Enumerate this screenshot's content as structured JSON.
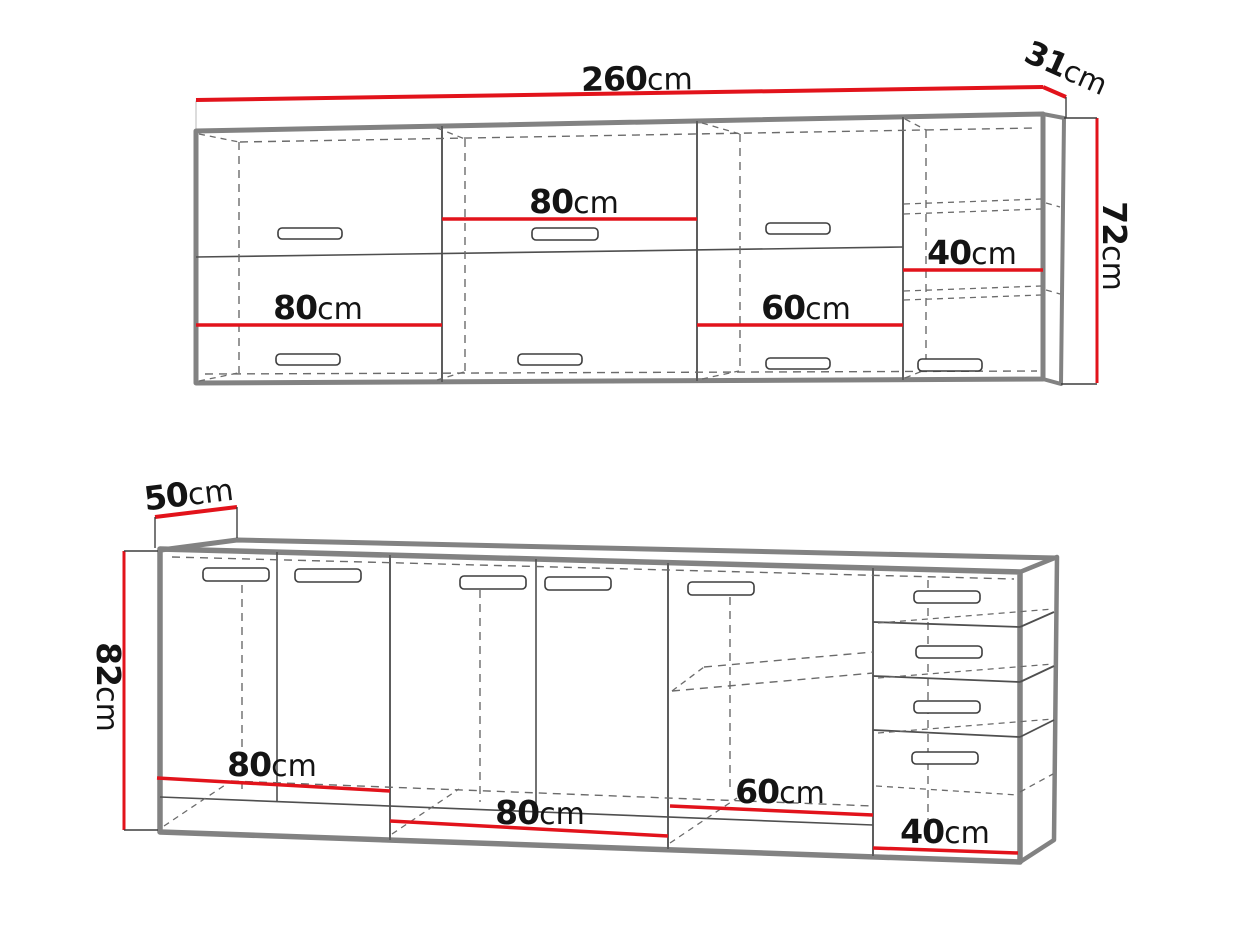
{
  "diagram": {
    "kind": "kitchen-cabinet-dimension-drawing",
    "colors": {
      "dimension_red": "#e2131b",
      "cabinet_outline_gray": "#828282",
      "detail_line_gray": "#4f4f4f",
      "text_black": "#141414",
      "background": "#ffffff"
    },
    "upper_cabinet": {
      "width": {
        "value": "260",
        "unit": "cm"
      },
      "depth": {
        "value": "31",
        "unit": "cm"
      },
      "height": {
        "value": "72",
        "unit": "cm"
      },
      "sections": [
        {
          "width": {
            "value": "80",
            "unit": "cm"
          }
        },
        {
          "width": {
            "value": "80",
            "unit": "cm"
          }
        },
        {
          "width": {
            "value": "60",
            "unit": "cm"
          }
        },
        {
          "width": {
            "value": "40",
            "unit": "cm"
          }
        }
      ]
    },
    "base_cabinet": {
      "depth": {
        "value": "50",
        "unit": "cm"
      },
      "height": {
        "value": "82",
        "unit": "cm"
      },
      "sections": [
        {
          "width": {
            "value": "80",
            "unit": "cm"
          }
        },
        {
          "width": {
            "value": "80",
            "unit": "cm"
          }
        },
        {
          "width": {
            "value": "60",
            "unit": "cm"
          }
        },
        {
          "width": {
            "value": "40",
            "unit": "cm"
          }
        }
      ]
    }
  }
}
